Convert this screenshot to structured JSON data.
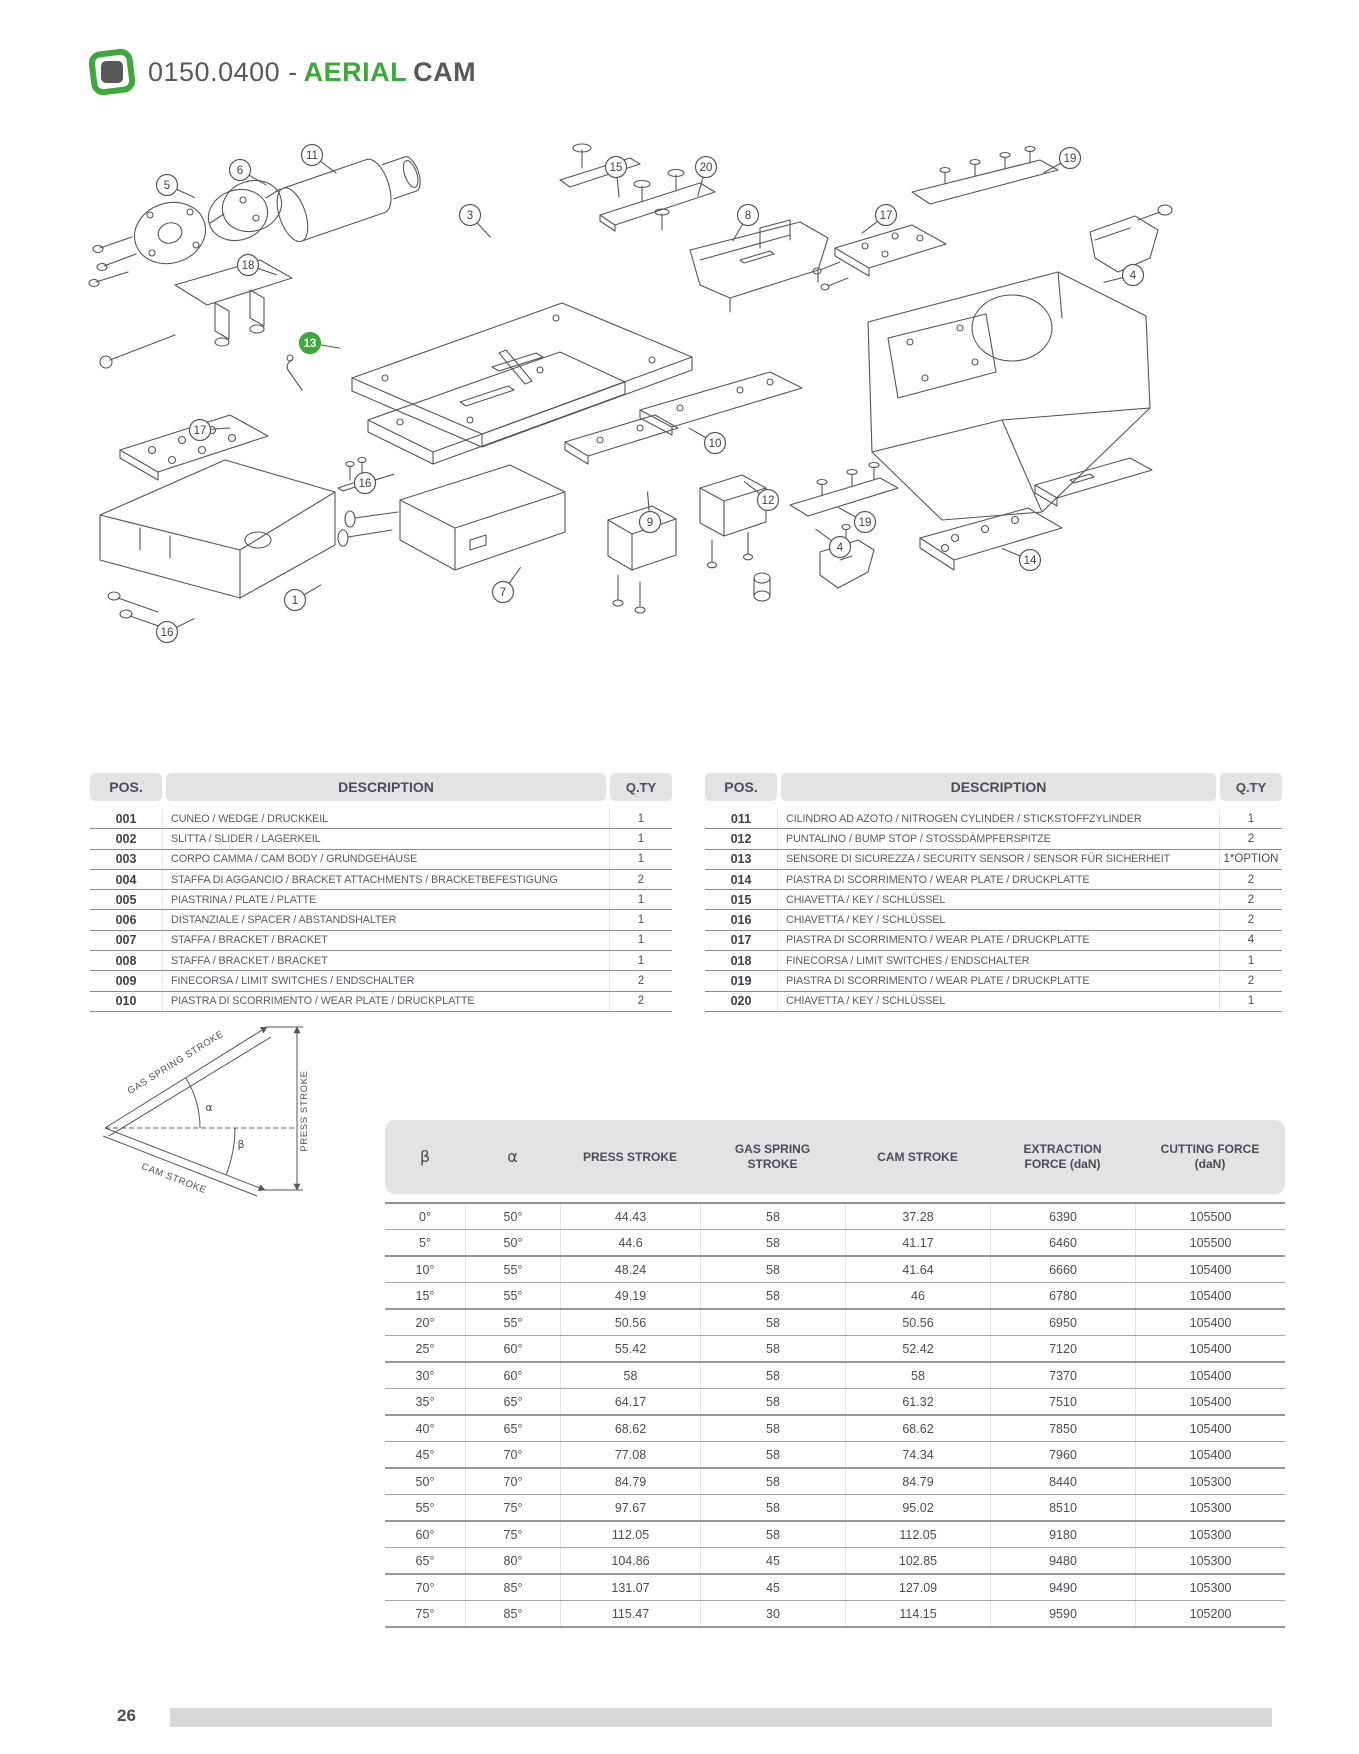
{
  "header": {
    "code": "0150.0400 -",
    "product_green": "AERIAL",
    "product_dark": "CAM"
  },
  "colors": {
    "accent_green": "#3fa83c",
    "dark_text": "#4d4f52",
    "table_band": "#e3e3e4",
    "footer_bar": "#d8d8d8"
  },
  "diagram": {
    "callouts": [
      {
        "n": "5",
        "x": 167,
        "y": 65
      },
      {
        "n": "6",
        "x": 240,
        "y": 50
      },
      {
        "n": "11",
        "x": 312,
        "y": 35
      },
      {
        "n": "15",
        "x": 616,
        "y": 47
      },
      {
        "n": "20",
        "x": 706,
        "y": 47
      },
      {
        "n": "3",
        "x": 470,
        "y": 95
      },
      {
        "n": "8",
        "x": 748,
        "y": 95
      },
      {
        "n": "17",
        "x": 886,
        "y": 95
      },
      {
        "n": "19",
        "x": 1070,
        "y": 38
      },
      {
        "n": "4",
        "x": 1133,
        "y": 155
      },
      {
        "n": "18",
        "x": 248,
        "y": 145
      },
      {
        "n": "13",
        "x": 310,
        "y": 223,
        "hl": true
      },
      {
        "n": "17",
        "x": 200,
        "y": 310
      },
      {
        "n": "16",
        "x": 365,
        "y": 363
      },
      {
        "n": "10",
        "x": 715,
        "y": 323
      },
      {
        "n": "12",
        "x": 768,
        "y": 380
      },
      {
        "n": "9",
        "x": 650,
        "y": 402
      },
      {
        "n": "19",
        "x": 865,
        "y": 402
      },
      {
        "n": "7",
        "x": 503,
        "y": 472
      },
      {
        "n": "1",
        "x": 295,
        "y": 480
      },
      {
        "n": "16",
        "x": 167,
        "y": 512
      },
      {
        "n": "4",
        "x": 840,
        "y": 427
      },
      {
        "n": "14",
        "x": 1030,
        "y": 440
      }
    ]
  },
  "parts": {
    "col_pos": "POS.",
    "col_desc": "DESCRIPTION",
    "col_qty": "Q.TY",
    "left": [
      {
        "pos": "001",
        "desc": "CUNEO / WEDGE / DRUCKKEIL",
        "qty": "1"
      },
      {
        "pos": "002",
        "desc": "SLITTA / SLIDER / LAGERKEIL",
        "qty": "1"
      },
      {
        "pos": "003",
        "desc": "CORPO CAMMA / CAM BODY / GRUNDGEHÄUSE",
        "qty": "1"
      },
      {
        "pos": "004",
        "desc": "STAFFA DI AGGANCIO / BRACKET ATTACHMENTS / BRACKETBEFESTIGUNG",
        "qty": "2"
      },
      {
        "pos": "005",
        "desc": "PIASTRINA / PLATE / PLATTE",
        "qty": "1"
      },
      {
        "pos": "006",
        "desc": "DISTANZIALE / SPACER / ABSTANDSHALTER",
        "qty": "1"
      },
      {
        "pos": "007",
        "desc": "STAFFA / BRACKET / BRACKET",
        "qty": "1"
      },
      {
        "pos": "008",
        "desc": "STAFFA / BRACKET / BRACKET",
        "qty": "1"
      },
      {
        "pos": "009",
        "desc": "FINECORSA / LIMIT SWITCHES / ENDSCHALTER",
        "qty": "2"
      },
      {
        "pos": "010",
        "desc": "PIASTRA DI SCORRIMENTO  /  WEAR PLATE /  DRUCKPLATTE",
        "qty": "2"
      }
    ],
    "right": [
      {
        "pos": "011",
        "desc": "CILINDRO AD AZOTO / NITROGEN CYLINDER / STICKSTOFFZYLINDER",
        "qty": "1"
      },
      {
        "pos": "012",
        "desc": "PUNTALINO / BUMP STOP /  STOSSDÄMPFERSPITZE",
        "qty": "2"
      },
      {
        "pos": "013",
        "desc": "SENSORE DI SICUREZZA / SECURITY SENSOR / SENSOR FÜR SICHERHEIT",
        "qty": "1*OPTION"
      },
      {
        "pos": "014",
        "desc": "PIASTRA DI SCORRIMENTO  /  WEAR PLATE /  DRUCKPLATTE",
        "qty": "2"
      },
      {
        "pos": "015",
        "desc": "CHIAVETTA / KEY / SCHLÜSSEL",
        "qty": "2"
      },
      {
        "pos": "016",
        "desc": "CHIAVETTA / KEY / SCHLÜSSEL",
        "qty": "2"
      },
      {
        "pos": "017",
        "desc": "PIASTRA DI SCORRIMENTO  /  WEAR PLATE /  DRUCKPLATTE",
        "qty": "4"
      },
      {
        "pos": "018",
        "desc": "FINECORSA / LIMIT SWITCHES / ENDSCHALTER",
        "qty": "1"
      },
      {
        "pos": "019",
        "desc": "PIASTRA DI SCORRIMENTO  /  WEAR PLATE /  DRUCKPLATTE",
        "qty": "2"
      },
      {
        "pos": "020",
        "desc": "CHIAVETTA / KEY / SCHLÜSSEL",
        "qty": "1"
      }
    ]
  },
  "stroke_diagram": {
    "gas": "GAS SPRING STROKE",
    "press": "PRESS STROKE",
    "cam": "CAM STROKE",
    "alpha": "α",
    "beta": "β"
  },
  "spec": {
    "headers": [
      "β",
      "α",
      "PRESS STROKE",
      "GAS SPRING STROKE",
      "CAM STROKE",
      "EXTRACTION FORCE (daN)",
      "CUTTING FORCE (daN)"
    ],
    "rows": [
      [
        "0°",
        "50°",
        "44.43",
        "58",
        "37.28",
        "6390",
        "105500"
      ],
      [
        "5°",
        "50°",
        "44.6",
        "58",
        "41.17",
        "6460",
        "105500"
      ],
      [
        "10°",
        "55°",
        "48.24",
        "58",
        "41.64",
        "6660",
        "105400"
      ],
      [
        "15°",
        "55°",
        "49.19",
        "58",
        "46",
        "6780",
        "105400"
      ],
      [
        "20°",
        "55°",
        "50.56",
        "58",
        "50.56",
        "6950",
        "105400"
      ],
      [
        "25°",
        "60°",
        "55.42",
        "58",
        "52.42",
        "7120",
        "105400"
      ],
      [
        "30°",
        "60°",
        "58",
        "58",
        "58",
        "7370",
        "105400"
      ],
      [
        "35°",
        "65°",
        "64.17",
        "58",
        "61.32",
        "7510",
        "105400"
      ],
      [
        "40°",
        "65°",
        "68.62",
        "58",
        "68.62",
        "7850",
        "105400"
      ],
      [
        "45°",
        "70°",
        "77.08",
        "58",
        "74.34",
        "7960",
        "105400"
      ],
      [
        "50°",
        "70°",
        "84.79",
        "58",
        "84.79",
        "8440",
        "105300"
      ],
      [
        "55°",
        "75°",
        "97.67",
        "58",
        "95.02",
        "8510",
        "105300"
      ],
      [
        "60°",
        "75°",
        "112.05",
        "58",
        "112.05",
        "9180",
        "105300"
      ],
      [
        "65°",
        "80°",
        "104.86",
        "45",
        "102.85",
        "9480",
        "105300"
      ],
      [
        "70°",
        "85°",
        "131.07",
        "45",
        "127.09",
        "9490",
        "105300"
      ],
      [
        "75°",
        "85°",
        "115.47",
        "30",
        "114.15",
        "9590",
        "105200"
      ]
    ]
  },
  "footer": {
    "page": "26"
  }
}
